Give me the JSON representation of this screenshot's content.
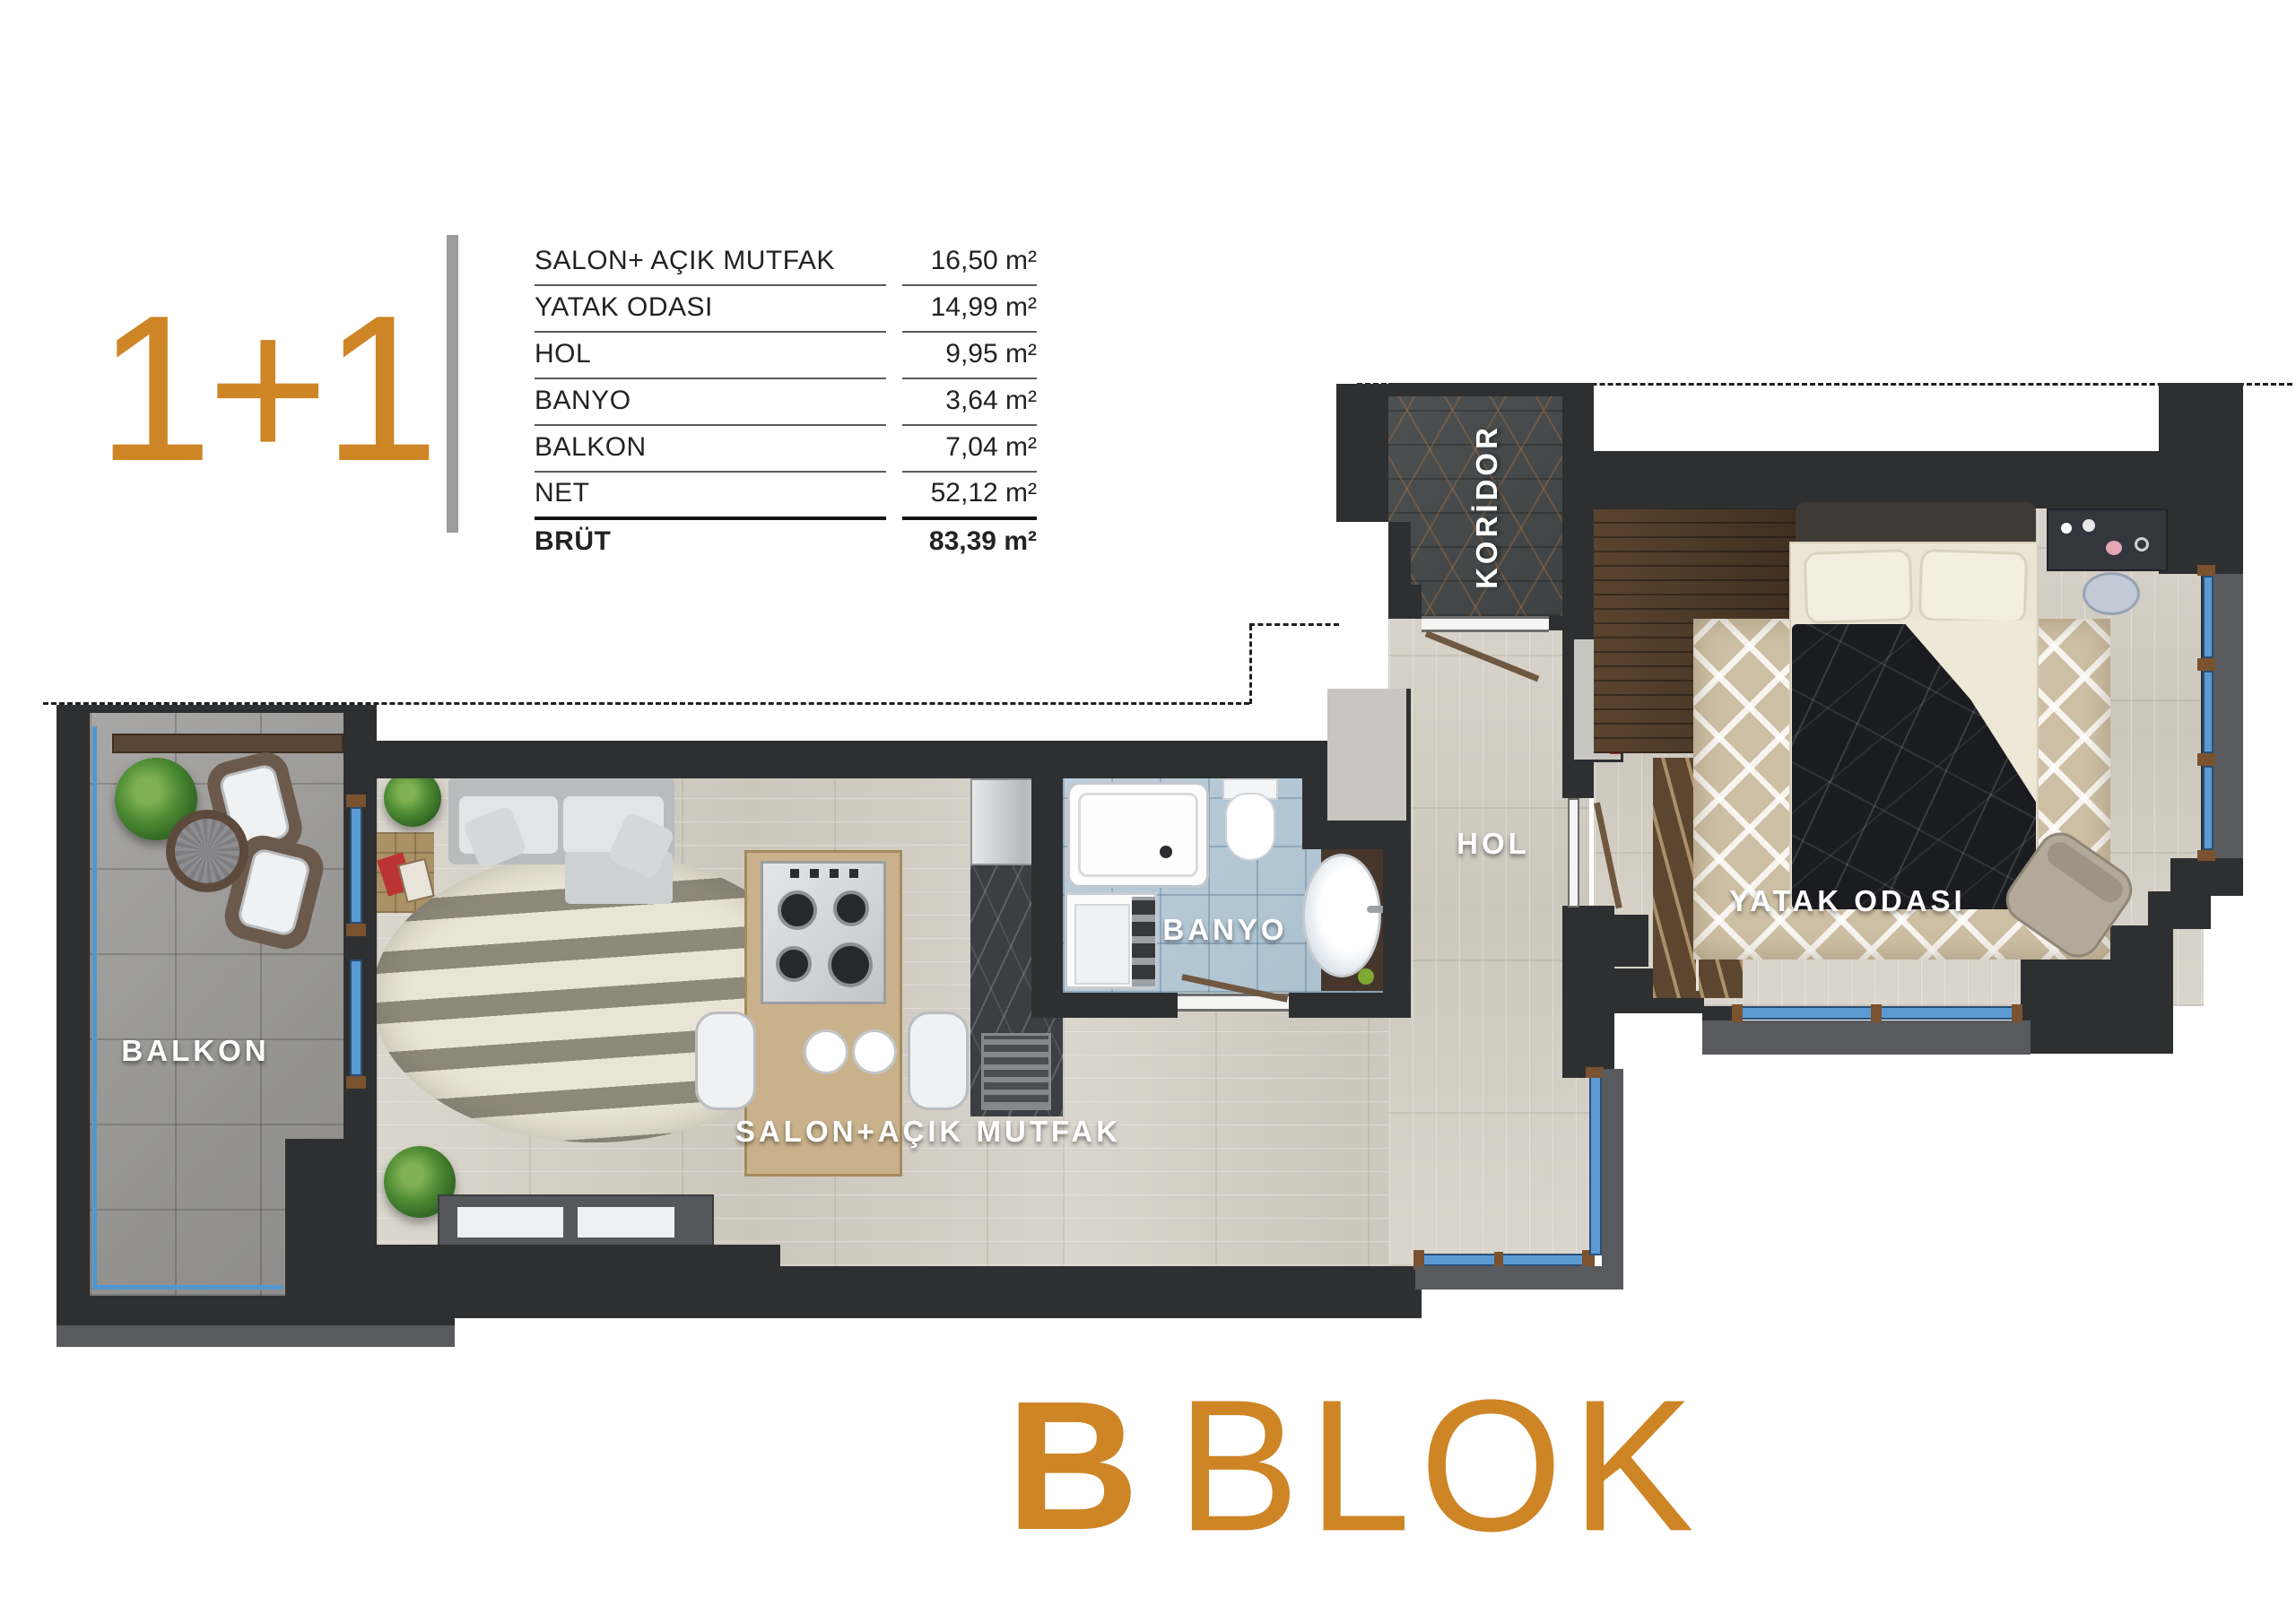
{
  "header": {
    "plan_type": "1+1"
  },
  "area_table": {
    "rows": [
      {
        "label": "SALON+ AÇIK MUTFAK",
        "value": "16,50 m²"
      },
      {
        "label": "YATAK ODASI",
        "value": "14,99 m²"
      },
      {
        "label": "HOL",
        "value": "9,95 m²"
      },
      {
        "label": "BANYO",
        "value": "3,64 m²"
      },
      {
        "label": "BALKON",
        "value": "7,04 m²"
      },
      {
        "label": "NET",
        "value": "52,12 m²"
      },
      {
        "label": "BRÜT",
        "value": "83,39 m²"
      }
    ]
  },
  "plan_labels": {
    "balkon": "BALKON",
    "salon": "SALON+AÇIK MUTFAK",
    "banyo": "BANYO",
    "hol": "HOL",
    "koridor": "KORİDOR",
    "yatak_odasi": "YATAK ODASI"
  },
  "footer": {
    "block_letter": "B",
    "block_word": "BLOK"
  },
  "colors": {
    "accent": "#CE8526",
    "wall": "#2E2F31",
    "window": "#5B9AD2"
  }
}
